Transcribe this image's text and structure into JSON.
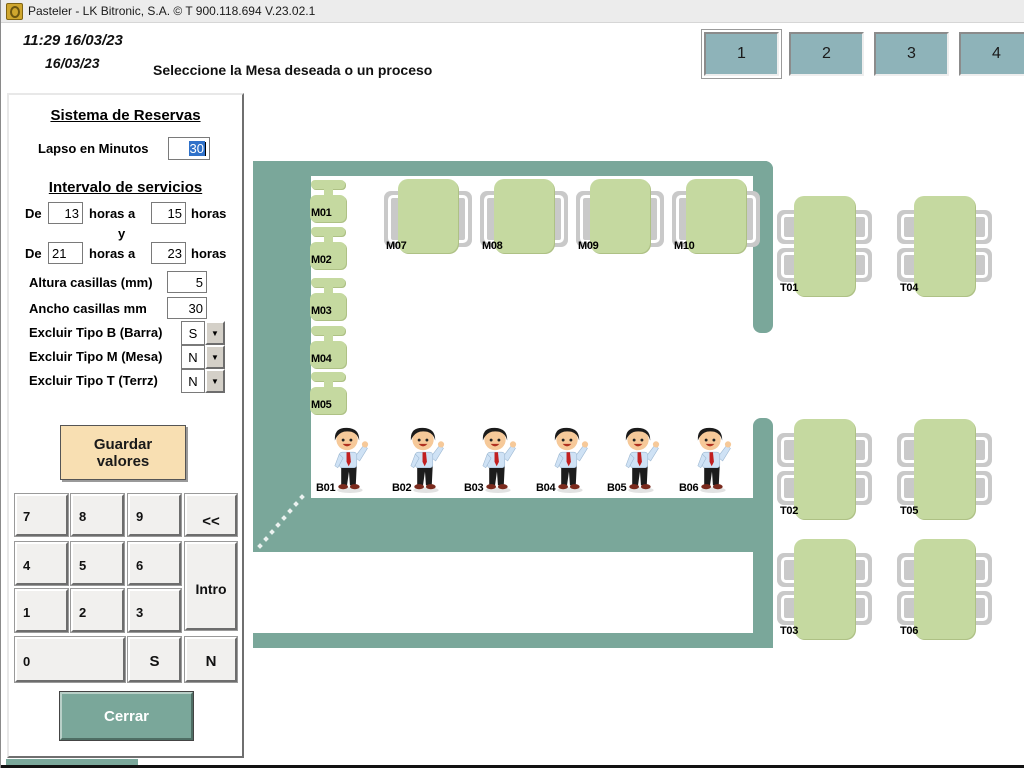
{
  "window": {
    "title": "Pasteler - LK Bitronic, S.A. ©  T 900.118.694 V.23.02.1"
  },
  "header": {
    "clock": "11:29 16/03/23",
    "date": "16/03/23",
    "instruction": "Seleccione la Mesa deseada o un proceso",
    "zone_buttons": [
      "1",
      "2",
      "3",
      "4"
    ]
  },
  "panel": {
    "title": "Sistema de Reservas",
    "lapso_label": "Lapso en Minutos",
    "lapso_value": "30",
    "intervalo_title": "Intervalo de servicios",
    "interval1": {
      "prefix": "De",
      "from": "13",
      "middle": "horas a",
      "to": "15",
      "suffix": "horas"
    },
    "conjunction": "y",
    "interval2": {
      "prefix": "De",
      "from": "21",
      "middle": "horas a",
      "to": "23",
      "suffix": "horas"
    },
    "altura_label": "Altura casillas (mm)",
    "altura_value": "5",
    "ancho_label": "Ancho casillas mm",
    "ancho_value": "30",
    "excluir": [
      {
        "label": "Excluir Tipo B (Barra)",
        "value": "S"
      },
      {
        "label": "Excluir Tipo M (Mesa)",
        "value": "N"
      },
      {
        "label": "Excluir Tipo T (Terrz)",
        "value": "N"
      }
    ],
    "save_button": "Guardar valores",
    "keypad": [
      "7",
      "8",
      "9",
      "<<",
      "4",
      "5",
      "6",
      "Intro",
      "1",
      "2",
      "3",
      "0",
      "S",
      "N"
    ],
    "close_button": "Cerrar"
  },
  "floorplan": {
    "m_small": [
      "M01",
      "M02",
      "M03",
      "M04",
      "M05"
    ],
    "m_large": [
      "M07",
      "M08",
      "M09",
      "M10"
    ],
    "bar_staff": [
      "B01",
      "B02",
      "B03",
      "B04",
      "B05",
      "B06"
    ],
    "terrace": [
      "T01",
      "T04",
      "T02",
      "T05",
      "T03",
      "T06"
    ]
  },
  "colors": {
    "wall_teal": "#7AA79A",
    "table_green": "#C5D9A0",
    "chair_gray": "#C9C9C9",
    "zone_button_teal": "#8EB3B9",
    "save_button_peach": "#F8DFB2",
    "selection_blue": "#2F71C9"
  }
}
